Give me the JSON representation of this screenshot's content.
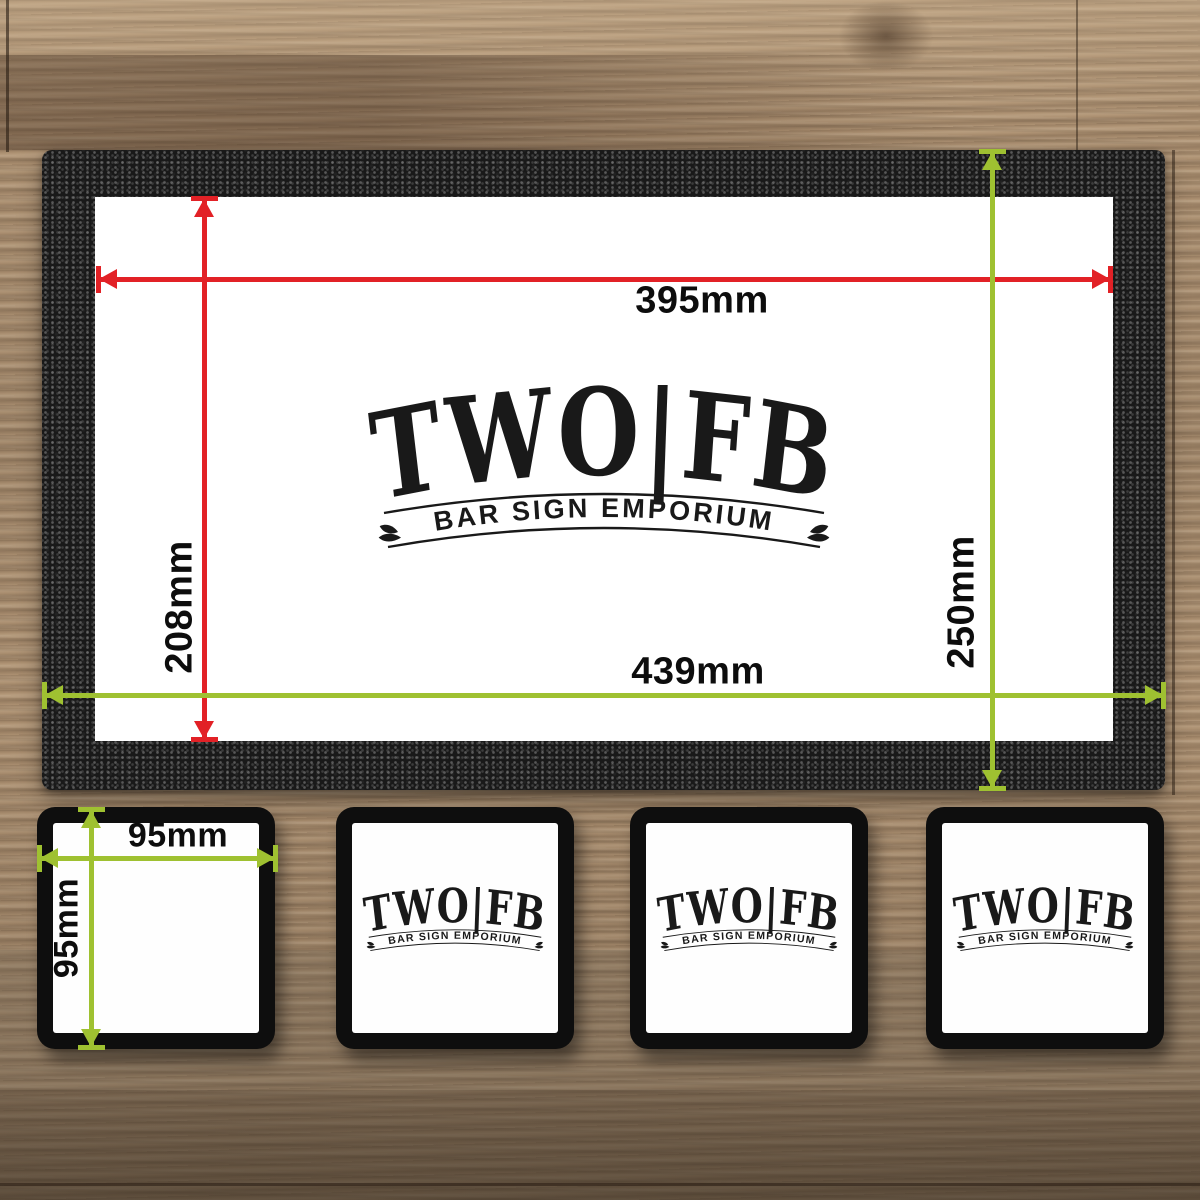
{
  "colors": {
    "inner_dimension_red": "#e22126",
    "outer_dimension_green": "#9fc131",
    "mat_black": "#191919",
    "logo_ink": "#191919"
  },
  "logo": {
    "main": "TWO|FB",
    "banner": "BAR SIGN EMPORIUM",
    "ornament_icon": "leaf-sprig"
  },
  "bar_runner": {
    "print_width_label": "395mm",
    "print_height_label": "208mm",
    "overall_width_label": "439mm",
    "overall_height_label": "250mm"
  },
  "coasters": {
    "count": 4,
    "width_label": "95mm",
    "height_label": "95mm"
  }
}
